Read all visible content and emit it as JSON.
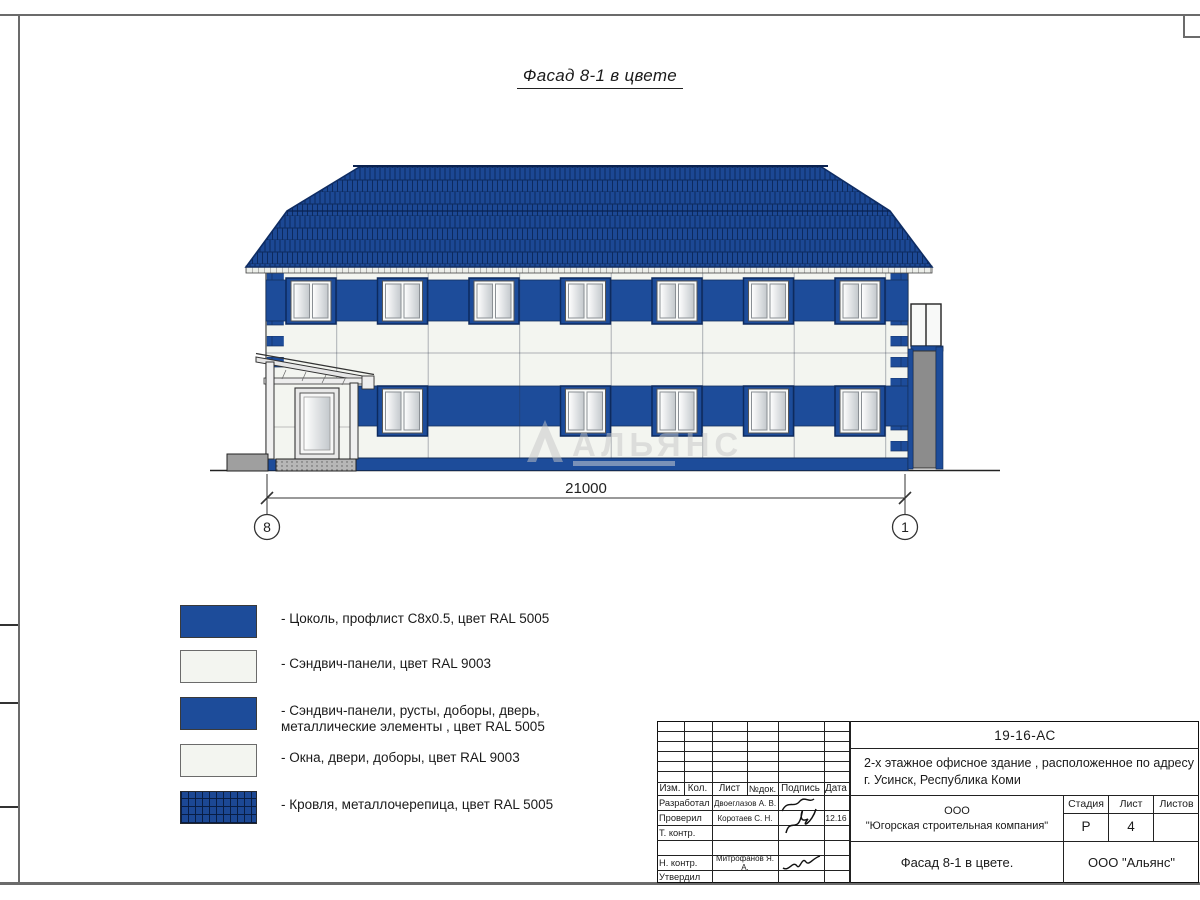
{
  "page": {
    "title": "Фасад 8-1 в цвете"
  },
  "facade": {
    "dimension_label": "21000",
    "axis_left": "8",
    "axis_right": "1",
    "watermark": "АЛЬЯНС"
  },
  "legend": {
    "items": [
      {
        "swatch": "blue",
        "label": "- Цоколь, профлист С8х0.5, цвет RAL 5005",
        "label2": ""
      },
      {
        "swatch": "white",
        "label": "- Сэндвич-панели, цвет RAL 9003",
        "label2": ""
      },
      {
        "swatch": "blue",
        "label": "- Сэндвич-панели, русты, доборы, дверь,",
        "label2": "металлические элементы , цвет RAL 5005"
      },
      {
        "swatch": "white",
        "label": "- Окна, двери, доборы, цвет RAL 9003",
        "label2": ""
      },
      {
        "swatch": "roof",
        "label": "- Кровля, металлочерепица, цвет RAL 5005",
        "label2": ""
      }
    ]
  },
  "title_block": {
    "doc_number": "19-16-АС",
    "project_line1": "2-х этажное офисное здание , расположенное по адресу",
    "project_line2": "г. Усинск, Республика Коми",
    "header": {
      "izm": "Изм.",
      "kol": "Кол.",
      "list": "Лист",
      "ndok": "№док.",
      "podpis": "Подпись",
      "data": "Дата"
    },
    "rows": [
      {
        "role": "Разработал",
        "name": "Двоеглазов А. В.",
        "date": ""
      },
      {
        "role": "Проверил",
        "name": "Коротаев С. Н.",
        "date": "12.16"
      },
      {
        "role": "Т. контр.",
        "name": "",
        "date": ""
      },
      {
        "role": "",
        "name": "",
        "date": ""
      },
      {
        "role": "Н. контр.",
        "name": "Митрофанов Я. А.",
        "date": ""
      },
      {
        "role": "Утвердил",
        "name": "",
        "date": ""
      }
    ],
    "company_line1": "ООО",
    "company_line2": "\"Югорская строительная компания\"",
    "stage_label": "Стадия",
    "sheet_label": "Лист",
    "sheets_label": "Листов",
    "stage_value": "Р",
    "sheet_value": "4",
    "sheets_value": "",
    "drawing_title": "Фасад 8-1 в цвете.",
    "contractor": "ООО \"Альянс\""
  },
  "colors": {
    "ral5005": "#1d4c9a",
    "ral9003": "#f3f5f0",
    "roof_dark": "#0d2a5e"
  }
}
